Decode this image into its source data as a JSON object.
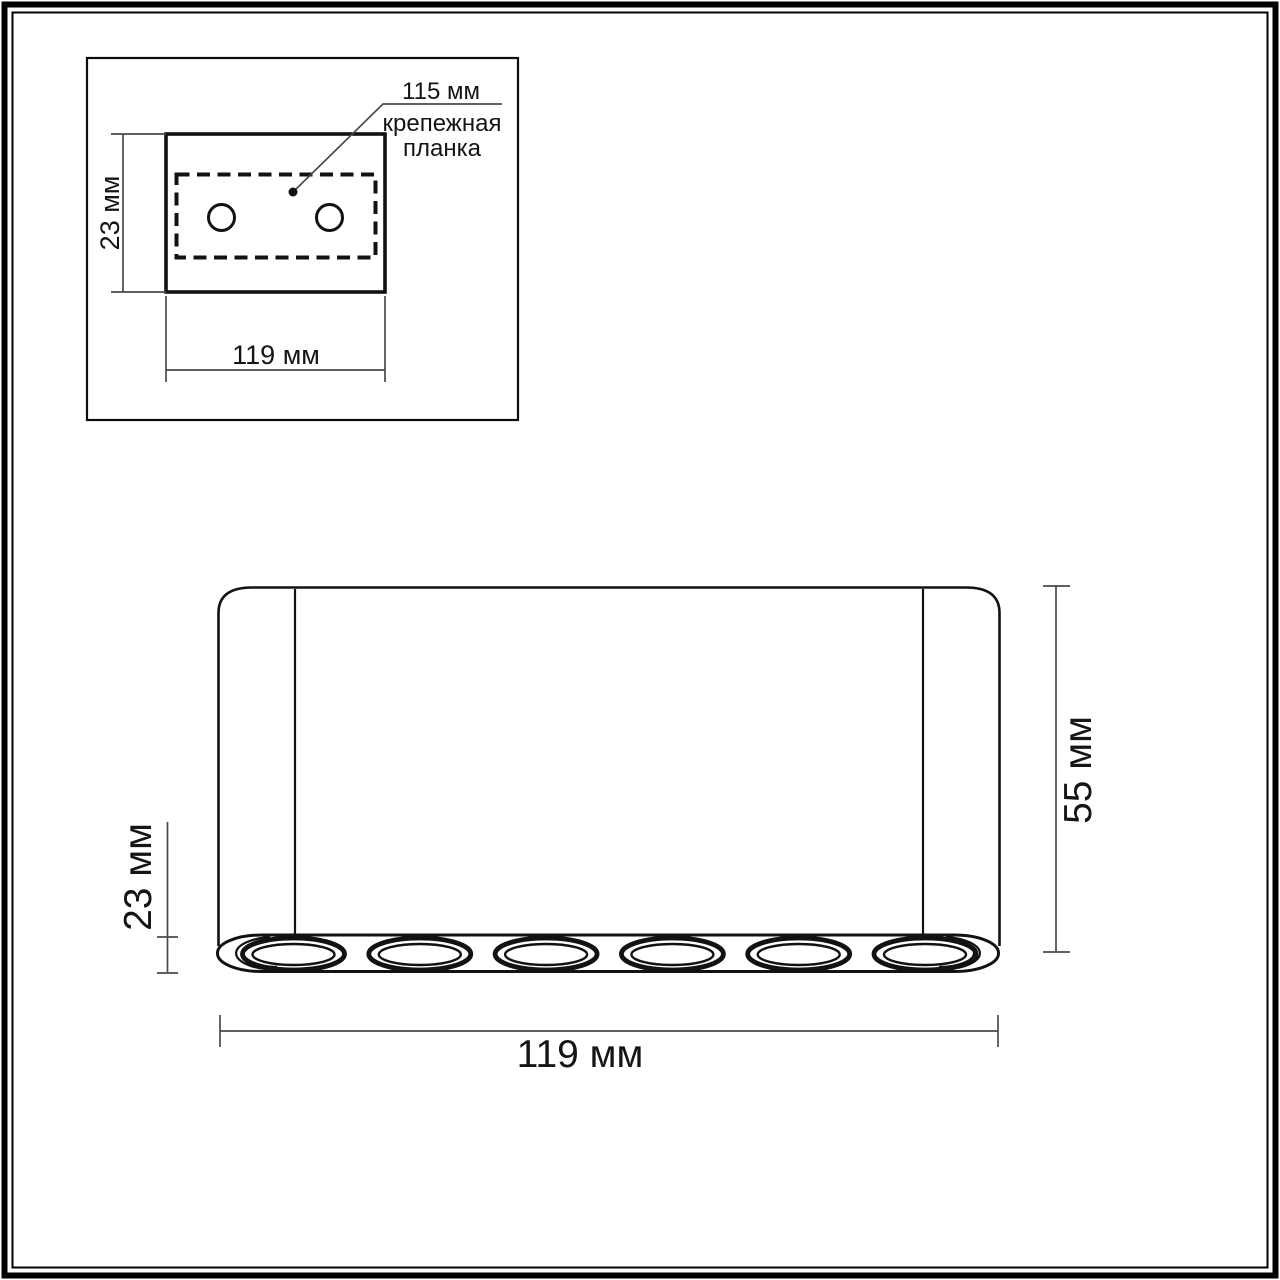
{
  "page": {
    "background": "#ffffff",
    "border_color": "#000000"
  },
  "inset_top_view": {
    "callout_value": "115 мм",
    "callout_line1": "крепежная",
    "callout_line2": "планка",
    "height_dim_label": "23 мм",
    "width_dim_label": "119 мм",
    "screw_hole_count": 2
  },
  "front_view": {
    "ring_height_dim_label": "23 мм",
    "body_height_dim_label": "55 мм",
    "width_dim_label": "119 мм",
    "light_count": 6
  },
  "colors": {
    "drawing_line": "#111111",
    "dimension_line": "#4a4a4a",
    "text": "#151515"
  }
}
